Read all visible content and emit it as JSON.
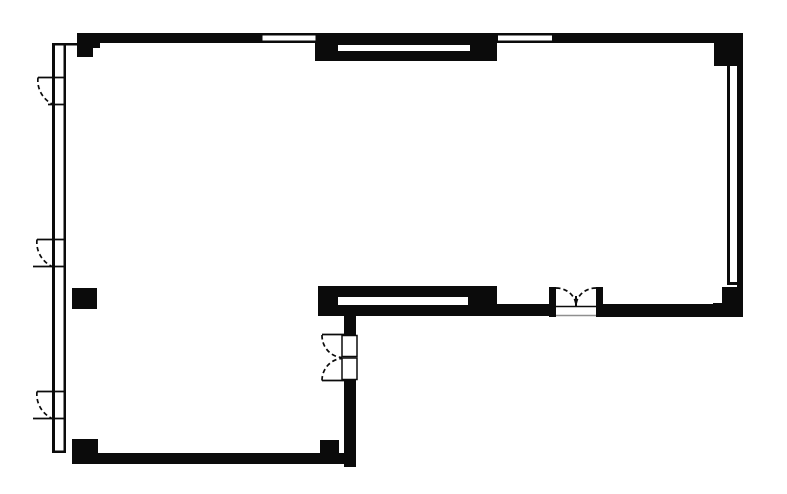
{
  "drawing": {
    "width": 787,
    "height": 494,
    "colors": {
      "wall": "#0b0b0b",
      "bg": "#ffffff",
      "shadow": "#8f8f8f"
    },
    "rects": [
      {
        "name": "top-wall-band",
        "x": 77,
        "y": 33,
        "w": 665,
        "h": 10
      },
      {
        "name": "top-left-corner-block",
        "x": 77,
        "y": 33,
        "w": 23,
        "h": 15
      },
      {
        "name": "top-left-corner-block-step",
        "x": 77,
        "y": 33,
        "w": 16,
        "h": 24
      },
      {
        "name": "top-center-window-block",
        "x": 315,
        "y": 33,
        "w": 182,
        "h": 28
      },
      {
        "name": "top-right-corner-block",
        "x": 714,
        "y": 33,
        "w": 29,
        "h": 33
      },
      {
        "name": "right-wall-outer-line",
        "x": 737,
        "y": 33,
        "w": 6,
        "h": 284
      },
      {
        "name": "right-wall-inner-glass-line",
        "x": 727,
        "y": 63,
        "w": 3,
        "h": 221
      },
      {
        "name": "right-wall-glass-end-tick",
        "x": 727,
        "y": 282,
        "w": 16,
        "h": 3
      },
      {
        "name": "bottom-right-corner-block",
        "x": 722,
        "y": 287,
        "w": 21,
        "h": 30
      },
      {
        "name": "bottom-right-corner-base",
        "x": 713,
        "y": 303,
        "w": 30,
        "h": 14
      },
      {
        "name": "right-section-bottom-wall",
        "x": 602,
        "y": 304,
        "w": 140,
        "h": 13
      },
      {
        "name": "mid-bottom-wall-segment",
        "x": 497,
        "y": 304,
        "w": 53,
        "h": 12
      },
      {
        "name": "entrance-door-jamb-left",
        "x": 549,
        "y": 287,
        "w": 7,
        "h": 30
      },
      {
        "name": "entrance-door-jamb-right",
        "x": 596,
        "y": 287,
        "w": 7,
        "h": 30
      },
      {
        "name": "mid-window-block",
        "x": 318,
        "y": 286,
        "w": 179,
        "h": 30
      },
      {
        "name": "interior-wall-upper",
        "x": 344,
        "y": 315,
        "w": 12,
        "h": 20
      },
      {
        "name": "interior-wall-lower",
        "x": 344,
        "y": 380,
        "w": 12,
        "h": 87
      },
      {
        "name": "bottom-wall-band",
        "x": 72,
        "y": 453,
        "w": 284,
        "h": 11
      },
      {
        "name": "bottom-left-corner-block",
        "x": 72,
        "y": 439,
        "w": 26,
        "h": 25
      },
      {
        "name": "bottom-wall-step-block",
        "x": 320,
        "y": 440,
        "w": 19,
        "h": 13
      },
      {
        "name": "column-square",
        "x": 72,
        "y": 288,
        "w": 25,
        "h": 21
      },
      {
        "name": "left-wall-outer-line",
        "x": 52,
        "y": 43,
        "w": 3,
        "h": 410
      },
      {
        "name": "left-wall-inner-line",
        "x": 63.5,
        "y": 43,
        "w": 2.5,
        "h": 410
      },
      {
        "name": "left-wall-top-tick",
        "x": 52,
        "y": 43,
        "w": 25,
        "h": 2.5
      },
      {
        "name": "left-wall-bottom-tick",
        "x": 52,
        "y": 450.5,
        "w": 14,
        "h": 2.5
      },
      {
        "name": "top-window-a-glass",
        "x": 262.5,
        "y": 35.5,
        "w": 53,
        "h": 5,
        "fill": "bg"
      },
      {
        "name": "top-window-b-glass",
        "x": 498,
        "y": 35.5,
        "w": 54,
        "h": 5,
        "fill": "bg"
      },
      {
        "name": "top-center-window-slot",
        "x": 338,
        "y": 45,
        "w": 132,
        "h": 6,
        "fill": "bg"
      },
      {
        "name": "mid-window-slot",
        "x": 338,
        "y": 297,
        "w": 130,
        "h": 8,
        "fill": "bg"
      },
      {
        "name": "interior-door-leaf-top",
        "x": 342,
        "y": 335.5,
        "w": 15,
        "h": 21,
        "fill": "bg",
        "stroke": true
      },
      {
        "name": "interior-door-leaf-bottom",
        "x": 342,
        "y": 358,
        "w": 15,
        "h": 21.5,
        "fill": "bg",
        "stroke": true
      }
    ],
    "paths": [
      {
        "name": "left-door-1-leaf",
        "d": "M66 77.5 L38 77.5"
      },
      {
        "name": "left-door-1-swing-arc",
        "d": "M38 77.5 A 28 27 0 0 0 53 104.5",
        "dash": true
      },
      {
        "name": "left-door-1-sill",
        "d": "M48 104.5 L66 104.5"
      },
      {
        "name": "left-door-2-leaf",
        "d": "M66 239.5 L37 239.5"
      },
      {
        "name": "left-door-2-swing-arc",
        "d": "M37 239.5 A 28 27 0 0 0 52 266.5",
        "dash": true
      },
      {
        "name": "left-door-2-sill",
        "d": "M33 266.5 L66 266.5"
      },
      {
        "name": "left-door-3-leaf",
        "d": "M66 391.5 L37 391.5"
      },
      {
        "name": "left-door-3-swing-arc",
        "d": "M37 391.5 A 28 27 0 0 0 52 418.5",
        "dash": true
      },
      {
        "name": "left-door-3-sill",
        "d": "M33 418.5 L66 418.5"
      },
      {
        "name": "entrance-door-left-swing-arc",
        "d": "M556 288 A 20 18 0 0 1 576 306",
        "dash": true
      },
      {
        "name": "entrance-door-right-swing-arc",
        "d": "M596 288 A 20 18 0 0 0 576 306",
        "dash": true
      },
      {
        "name": "entrance-door-center-meeting-tick",
        "d": "M576 296 L576 307",
        "w": 2
      },
      {
        "name": "entrance-door-threshold-line",
        "d": "M556 306.5 L596 306.5",
        "w": 1.6
      },
      {
        "name": "entrance-door-outer-edge-line",
        "d": "M556 315.5 L596 315.5",
        "w": 1.6,
        "color": "shadow"
      },
      {
        "name": "interior-door-top-cap-line",
        "d": "M322 334.5 L344 334.5"
      },
      {
        "name": "interior-door-bottom-cap-line",
        "d": "M322 380.5 L344 380.5"
      },
      {
        "name": "interior-door-top-swing-arc",
        "d": "M322 335 A 21 22 0 0 0 342 357.5",
        "dash": true
      },
      {
        "name": "interior-door-bottom-swing-arc",
        "d": "M322 380.5 A 21 22 0 0 1 342 358.5",
        "dash": true
      }
    ]
  }
}
